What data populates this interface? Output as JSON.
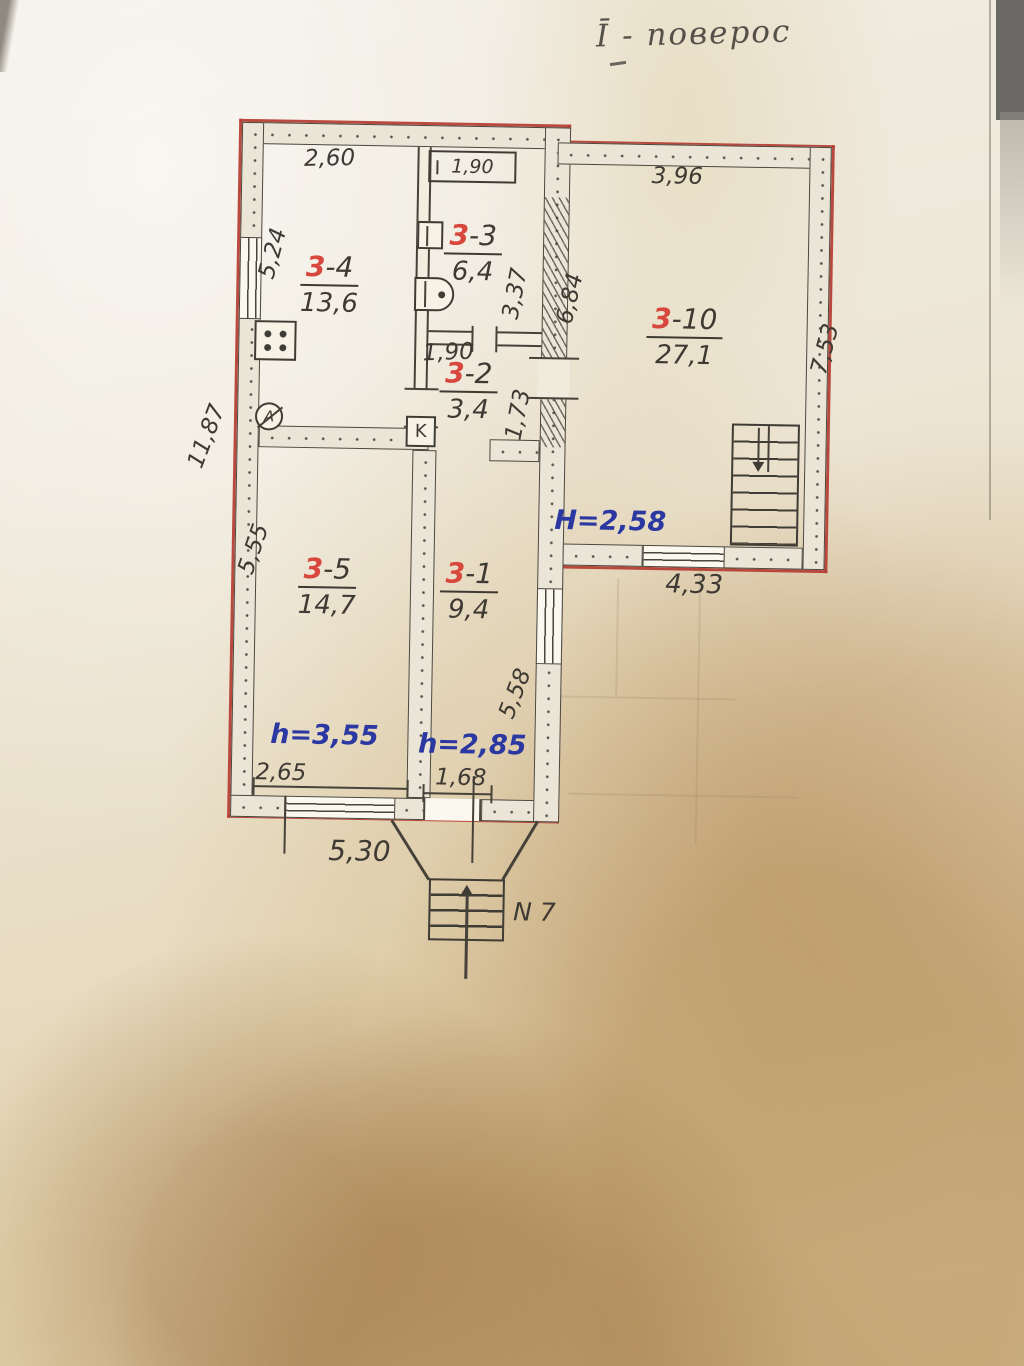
{
  "title": "Ī - поверос",
  "rooms": {
    "r34": {
      "num": "3",
      "suffix": "-4",
      "area": "13,6"
    },
    "r33": {
      "num": "3",
      "suffix": "-3",
      "area": "6,4"
    },
    "r32": {
      "num": "3",
      "suffix": "-2",
      "area": "3,4"
    },
    "r310": {
      "num": "3",
      "suffix": "-10",
      "area": "27,1"
    },
    "r35": {
      "num": "3",
      "suffix": "-5",
      "area": "14,7"
    },
    "r31": {
      "num": "3",
      "suffix": "-1",
      "area": "9,4"
    }
  },
  "dims": {
    "w260": "2,60",
    "bath190": "1,90",
    "w396": "3,96",
    "h524": "5,24",
    "h337": "3,37",
    "h684": "6,84",
    "h753": "7,53",
    "w190": "1,90",
    "h173": "1,73",
    "h1187": "11,87",
    "h555": "5,55",
    "w433": "4,33",
    "w265": "2,65",
    "w168": "1,68",
    "h558": "5,58",
    "w530": "5,30"
  },
  "heights": {
    "hall": "H=2,58",
    "r35": "h=3,55",
    "r31": "h=2,85"
  },
  "entrance": {
    "label": "N 7"
  },
  "fixtures": {
    "boiler": "K",
    "meter": "A"
  },
  "colors": {
    "outline_red": "#b64036",
    "ink_blue": "#2c38a2",
    "pencil": "#3e3a33",
    "room_red": "#d8473d"
  }
}
